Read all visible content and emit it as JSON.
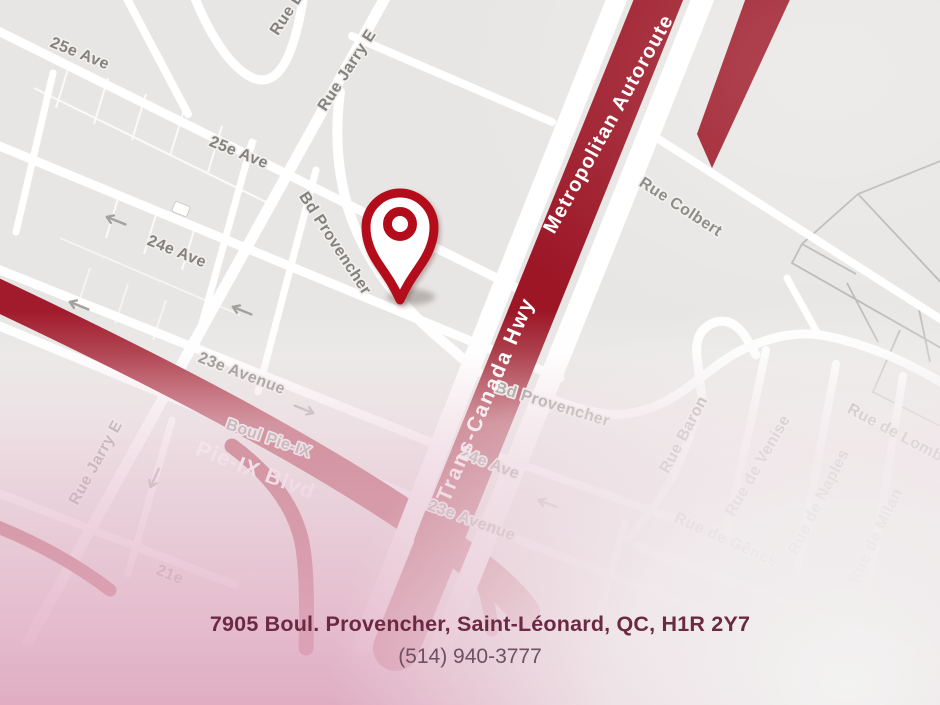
{
  "map": {
    "pin": {
      "name": "location-pin",
      "color": "#b30f1f"
    },
    "highway_labels": [
      {
        "text": "Trans-Canada Hwy"
      },
      {
        "text": "Metropolitan Autoroute"
      },
      {
        "text": "Pie-IX Blvd"
      }
    ],
    "road_labels": [
      {
        "text": "25e Ave"
      },
      {
        "text": "Rue B"
      },
      {
        "text": "Rue Jarry E"
      },
      {
        "text": "25e Ave"
      },
      {
        "text": "Bd Provencher"
      },
      {
        "text": "24e Ave"
      },
      {
        "text": "Rue Jarry E"
      },
      {
        "text": "23e Avenue"
      },
      {
        "text": "Boul Pie-IX"
      },
      {
        "text": "21e"
      },
      {
        "text": "Rue Colbert"
      },
      {
        "text": "Bd Provencher"
      },
      {
        "text": "24e Ave"
      },
      {
        "text": "23e Avenue"
      },
      {
        "text": "Rue Baron"
      },
      {
        "text": "Rue de Venise"
      },
      {
        "text": "Rue de Naples"
      },
      {
        "text": "Rue de Gênes"
      },
      {
        "text": "Rue de Milan"
      },
      {
        "text": "Rue de Lomb"
      }
    ],
    "colors": {
      "map_background": "#e8e6e4",
      "street_white": "#ffffff",
      "highway_red": "#9c1626",
      "pieix_red": "#a11b2c",
      "pin_red": "#b30f1f",
      "label_gray": "#85827d",
      "overlay_pink": "#e2b4c7"
    }
  },
  "footer": {
    "address": "7905 Boul. Provencher, Saint-Léonard, QC, H1R 2Y7",
    "phone": "(514) 940-3777"
  }
}
